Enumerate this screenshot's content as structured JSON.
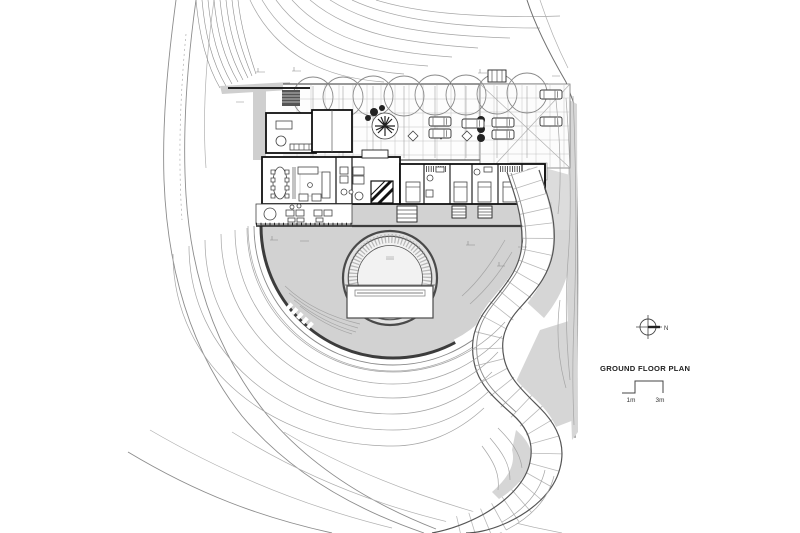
{
  "annotations": {
    "title": "GROUND FLOOR PLAN",
    "north_label": "N",
    "scale": {
      "left_label": "1m",
      "right_label": "3m"
    }
  },
  "colors": {
    "background": "#ffffff",
    "ink": "#1a1a1a",
    "wall": "#111111",
    "contour": "#a5a5a5",
    "terrace_fill": "#d2d2d2",
    "slope_fill": "#d6d6d6",
    "strip_fill": "#cfcfcf",
    "pool_court_fill": "#e2e2e2",
    "paving_tick": "#b8b8b8"
  },
  "icons": {
    "north_arrow": "compass-crosshair"
  }
}
